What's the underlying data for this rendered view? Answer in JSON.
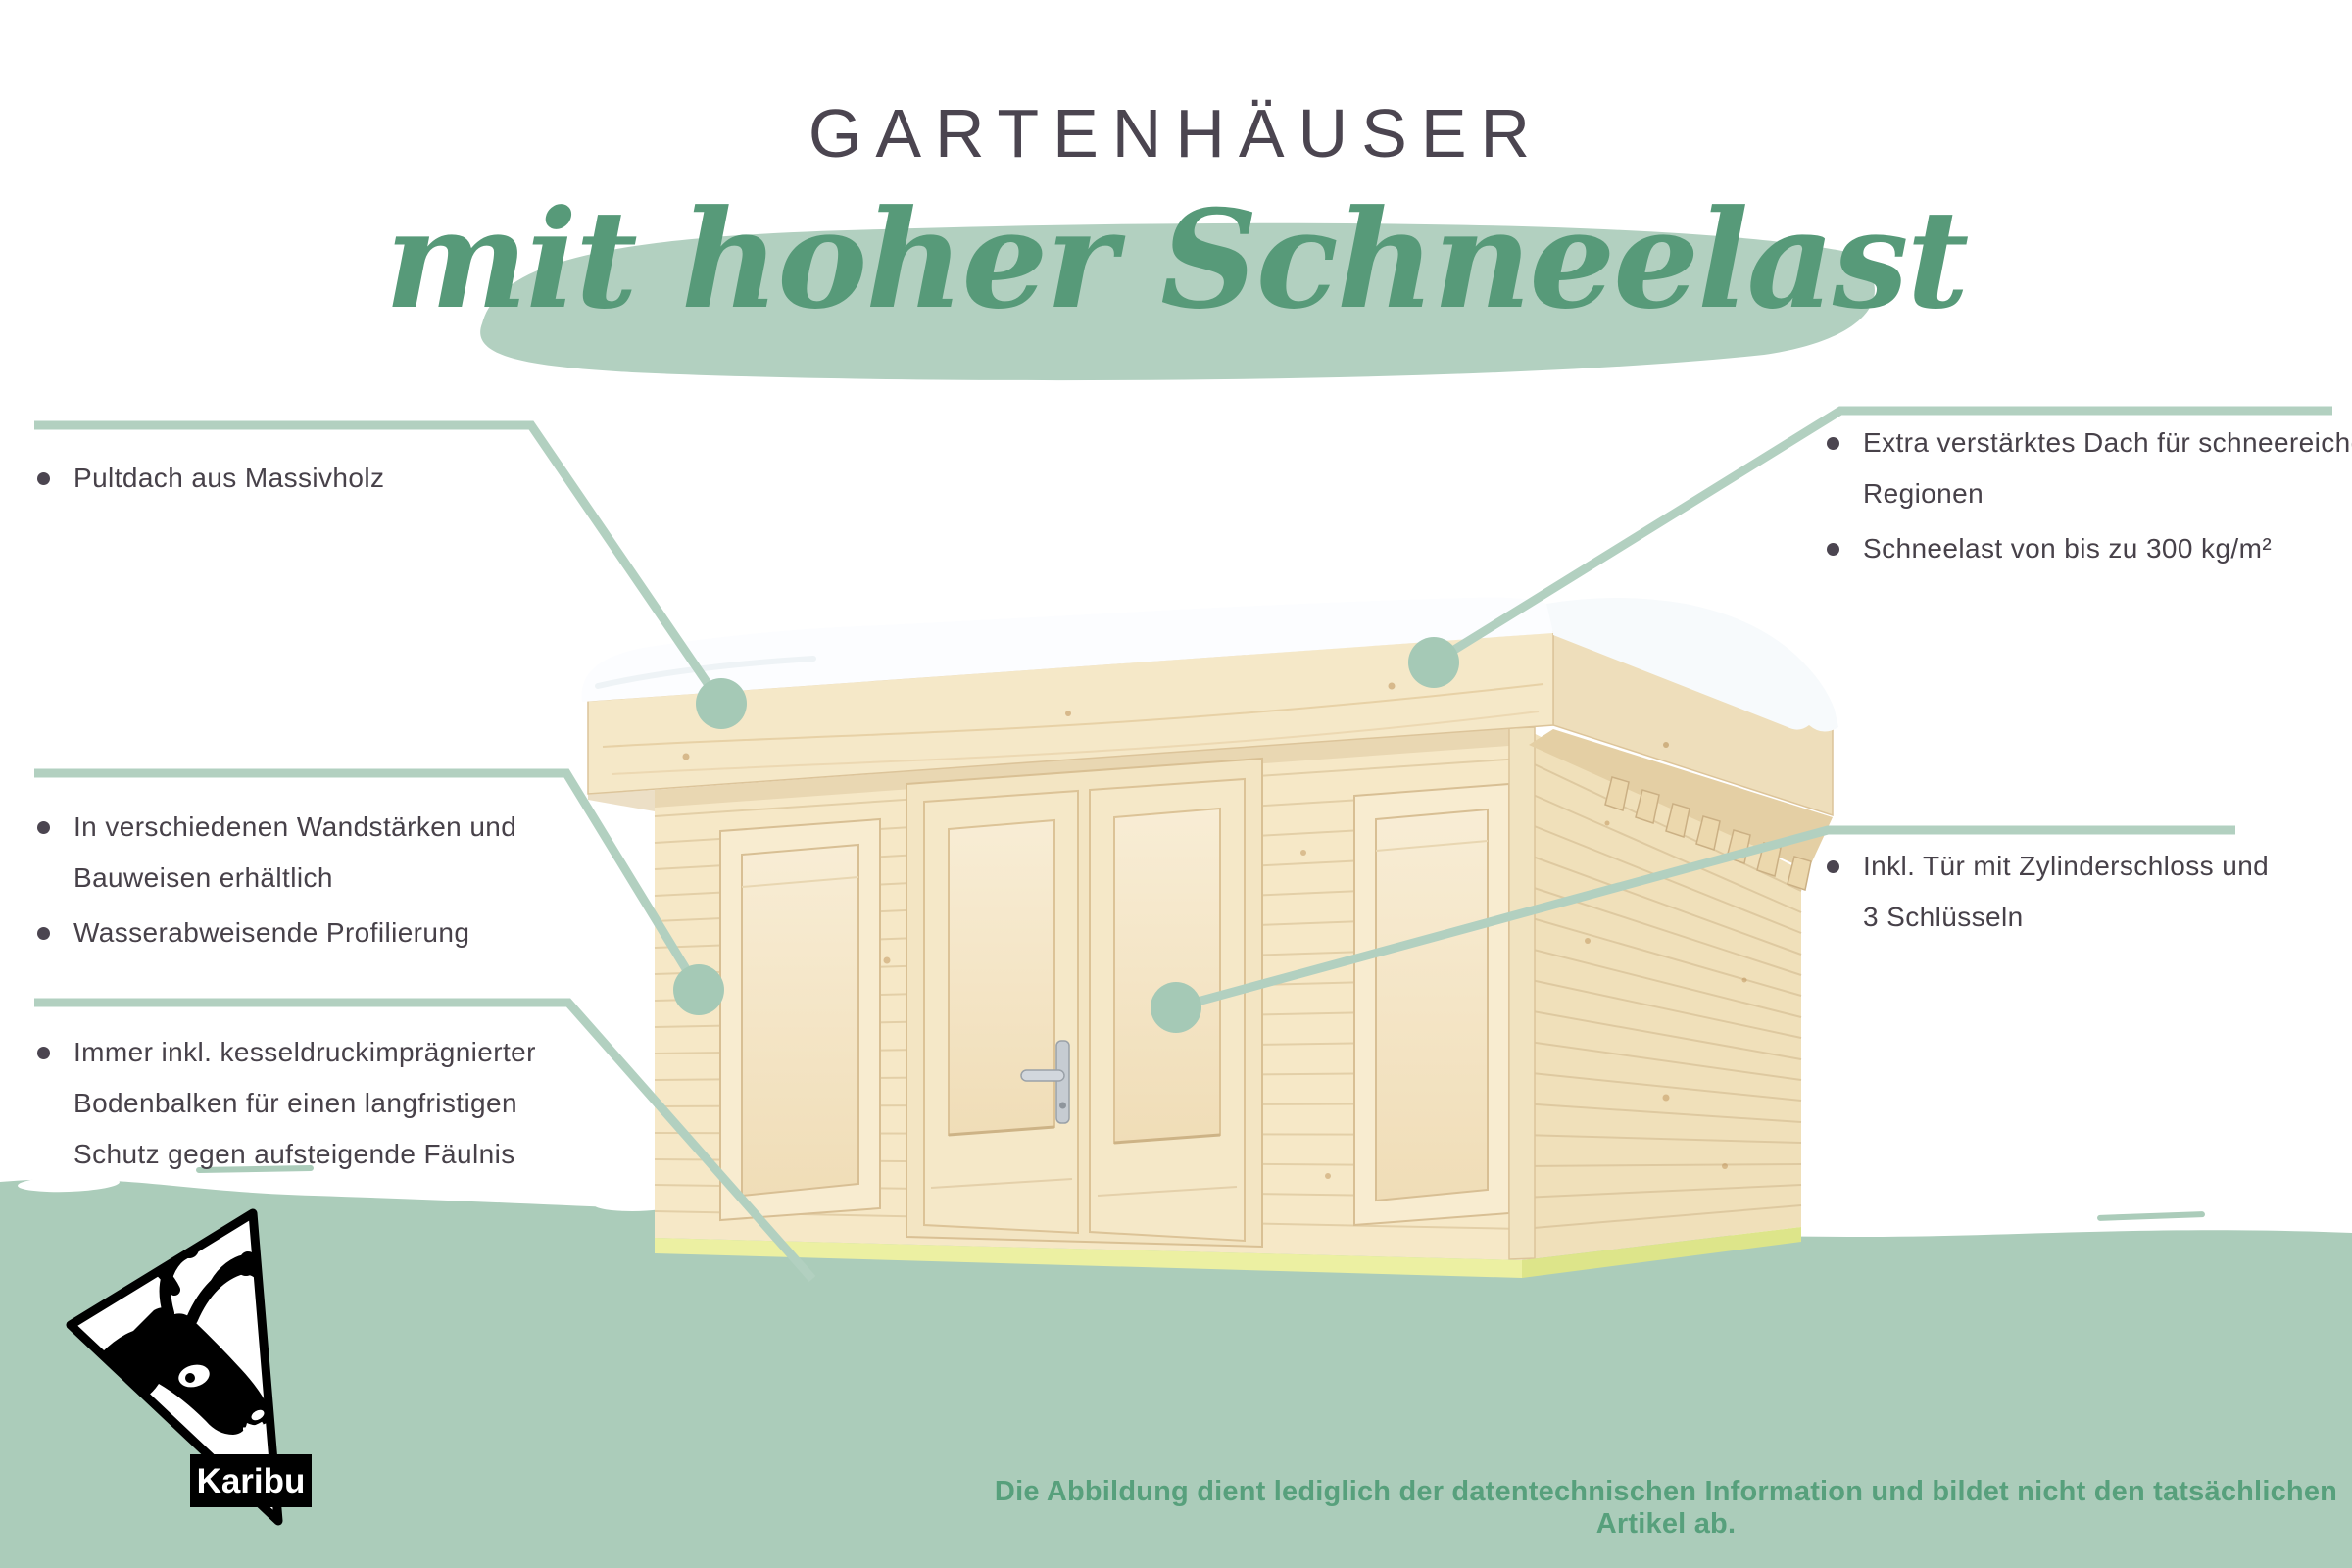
{
  "page": {
    "title": "GARTENHÄUSER",
    "subtitle": "mit hoher Schneelast",
    "disclaimer": "Die Abbildung dient lediglich der datentechnischen Information und bildet nicht den tatsächlichen Artikel ab."
  },
  "brand": {
    "logo_text": "Karibu",
    "logo_icon": "caribou-head-in-triangle"
  },
  "callouts": {
    "left_top": {
      "items": [
        {
          "lines": [
            "Pultdach aus Massivholz"
          ]
        }
      ]
    },
    "left_middle": {
      "items": [
        {
          "lines": [
            "In verschiedenen Wandstärken und",
            "Bauweisen erhältlich"
          ]
        },
        {
          "lines": [
            "Wasserabweisende Profilierung"
          ]
        }
      ]
    },
    "left_bottom": {
      "items": [
        {
          "lines": [
            "Immer inkl. kesseldruckimprägnierter",
            "Bodenbalken für einen langfristigen",
            "Schutz gegen aufsteigende Fäulnis"
          ]
        }
      ]
    },
    "right_top": {
      "items": [
        {
          "lines": [
            "Extra verstärktes Dach für schneereiche",
            "Regionen"
          ]
        },
        {
          "lines": [
            "Schneelast von bis zu 300 kg/m²"
          ]
        }
      ]
    },
    "right_middle": {
      "items": [
        {
          "lines": [
            "Inkl. Tür mit Zylinderschloss und",
            "3 Schlüsseln"
          ]
        }
      ]
    }
  },
  "scene": {
    "illustration": "garden-house-pent-roof-with-snow",
    "parts": [
      "roof-snow",
      "pent-roof-fascia",
      "front-wall",
      "side-wall",
      "left-window",
      "double-door",
      "right-window",
      "door-handle",
      "foundation-beams",
      "ground-band"
    ]
  },
  "colors": {
    "accent_green_light": "#b2d0c0",
    "ground_green": "#abccba",
    "script_green": "#579a79",
    "disclaimer_green": "#57a07c",
    "text_dark": "#474149",
    "title_dark": "#4b4550",
    "wood_light": "#f6e8c7",
    "wood_side": "#f0e0ba",
    "snow_white": "#fcfdff",
    "foundation_yellow": "#ecf0a2"
  }
}
